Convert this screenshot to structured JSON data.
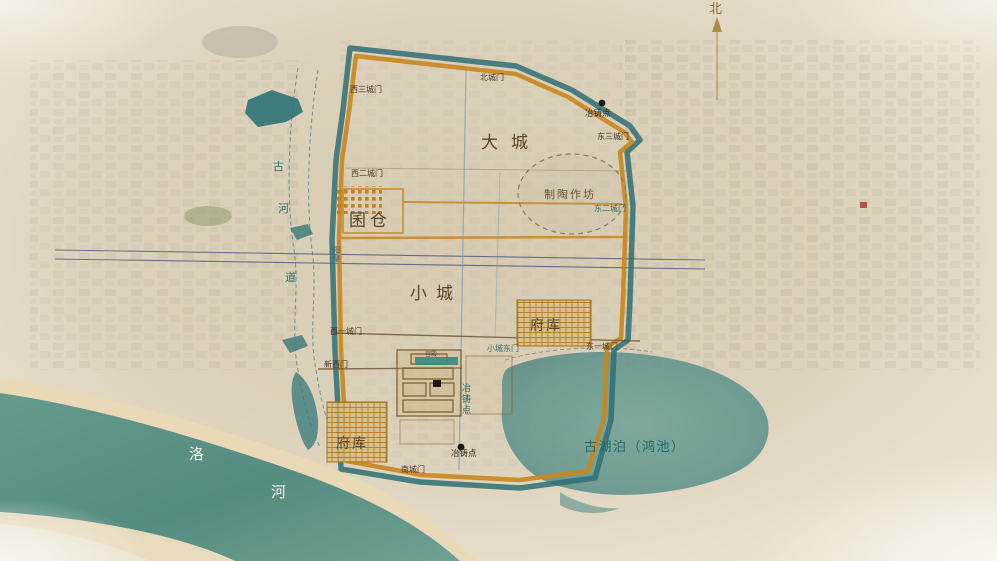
{
  "compass": {
    "north_label": "北"
  },
  "city_labels": {
    "dacheng": "大城",
    "xiaocheng": "小城",
    "quncang": "囷仓",
    "fuku_north": "府库",
    "fuku_south": "府库",
    "pottery_workshop": "制陶作坊",
    "palace_hall": "宫殿"
  },
  "gates": {
    "west_gate_3": "西三城门",
    "north_gate": "北城门",
    "east_gate_3": "东三城门",
    "west_gate_2": "西二城门",
    "east_gate_2": "东二城门",
    "west_gate_1": "西一城门",
    "new_west_gate": "新西门",
    "small_city_east_gate": "小城东门",
    "east_gate_1": "东一城门",
    "south_gate": "南城门"
  },
  "foundry_sites": {
    "north_label": "冶铸点",
    "middle_chars": [
      "冶",
      "铸",
      "点"
    ],
    "south_label": "冶铸点"
  },
  "water": {
    "lake_label": "古湖泊（鸿池）",
    "luo_river_chars": [
      "洛",
      "河"
    ],
    "old_channel_chars": [
      "古",
      "河",
      "道"
    ],
    "canal_chars": [
      "阳",
      "渠"
    ]
  },
  "colors": {
    "outer_wall_teal": "#2f6f74",
    "inner_wall_orange": "#c8861d",
    "water_teal": "#5b9287",
    "label_brown": "#5a4526",
    "label_teal": "#2e6e74",
    "parchment": "#ddd1bb"
  }
}
